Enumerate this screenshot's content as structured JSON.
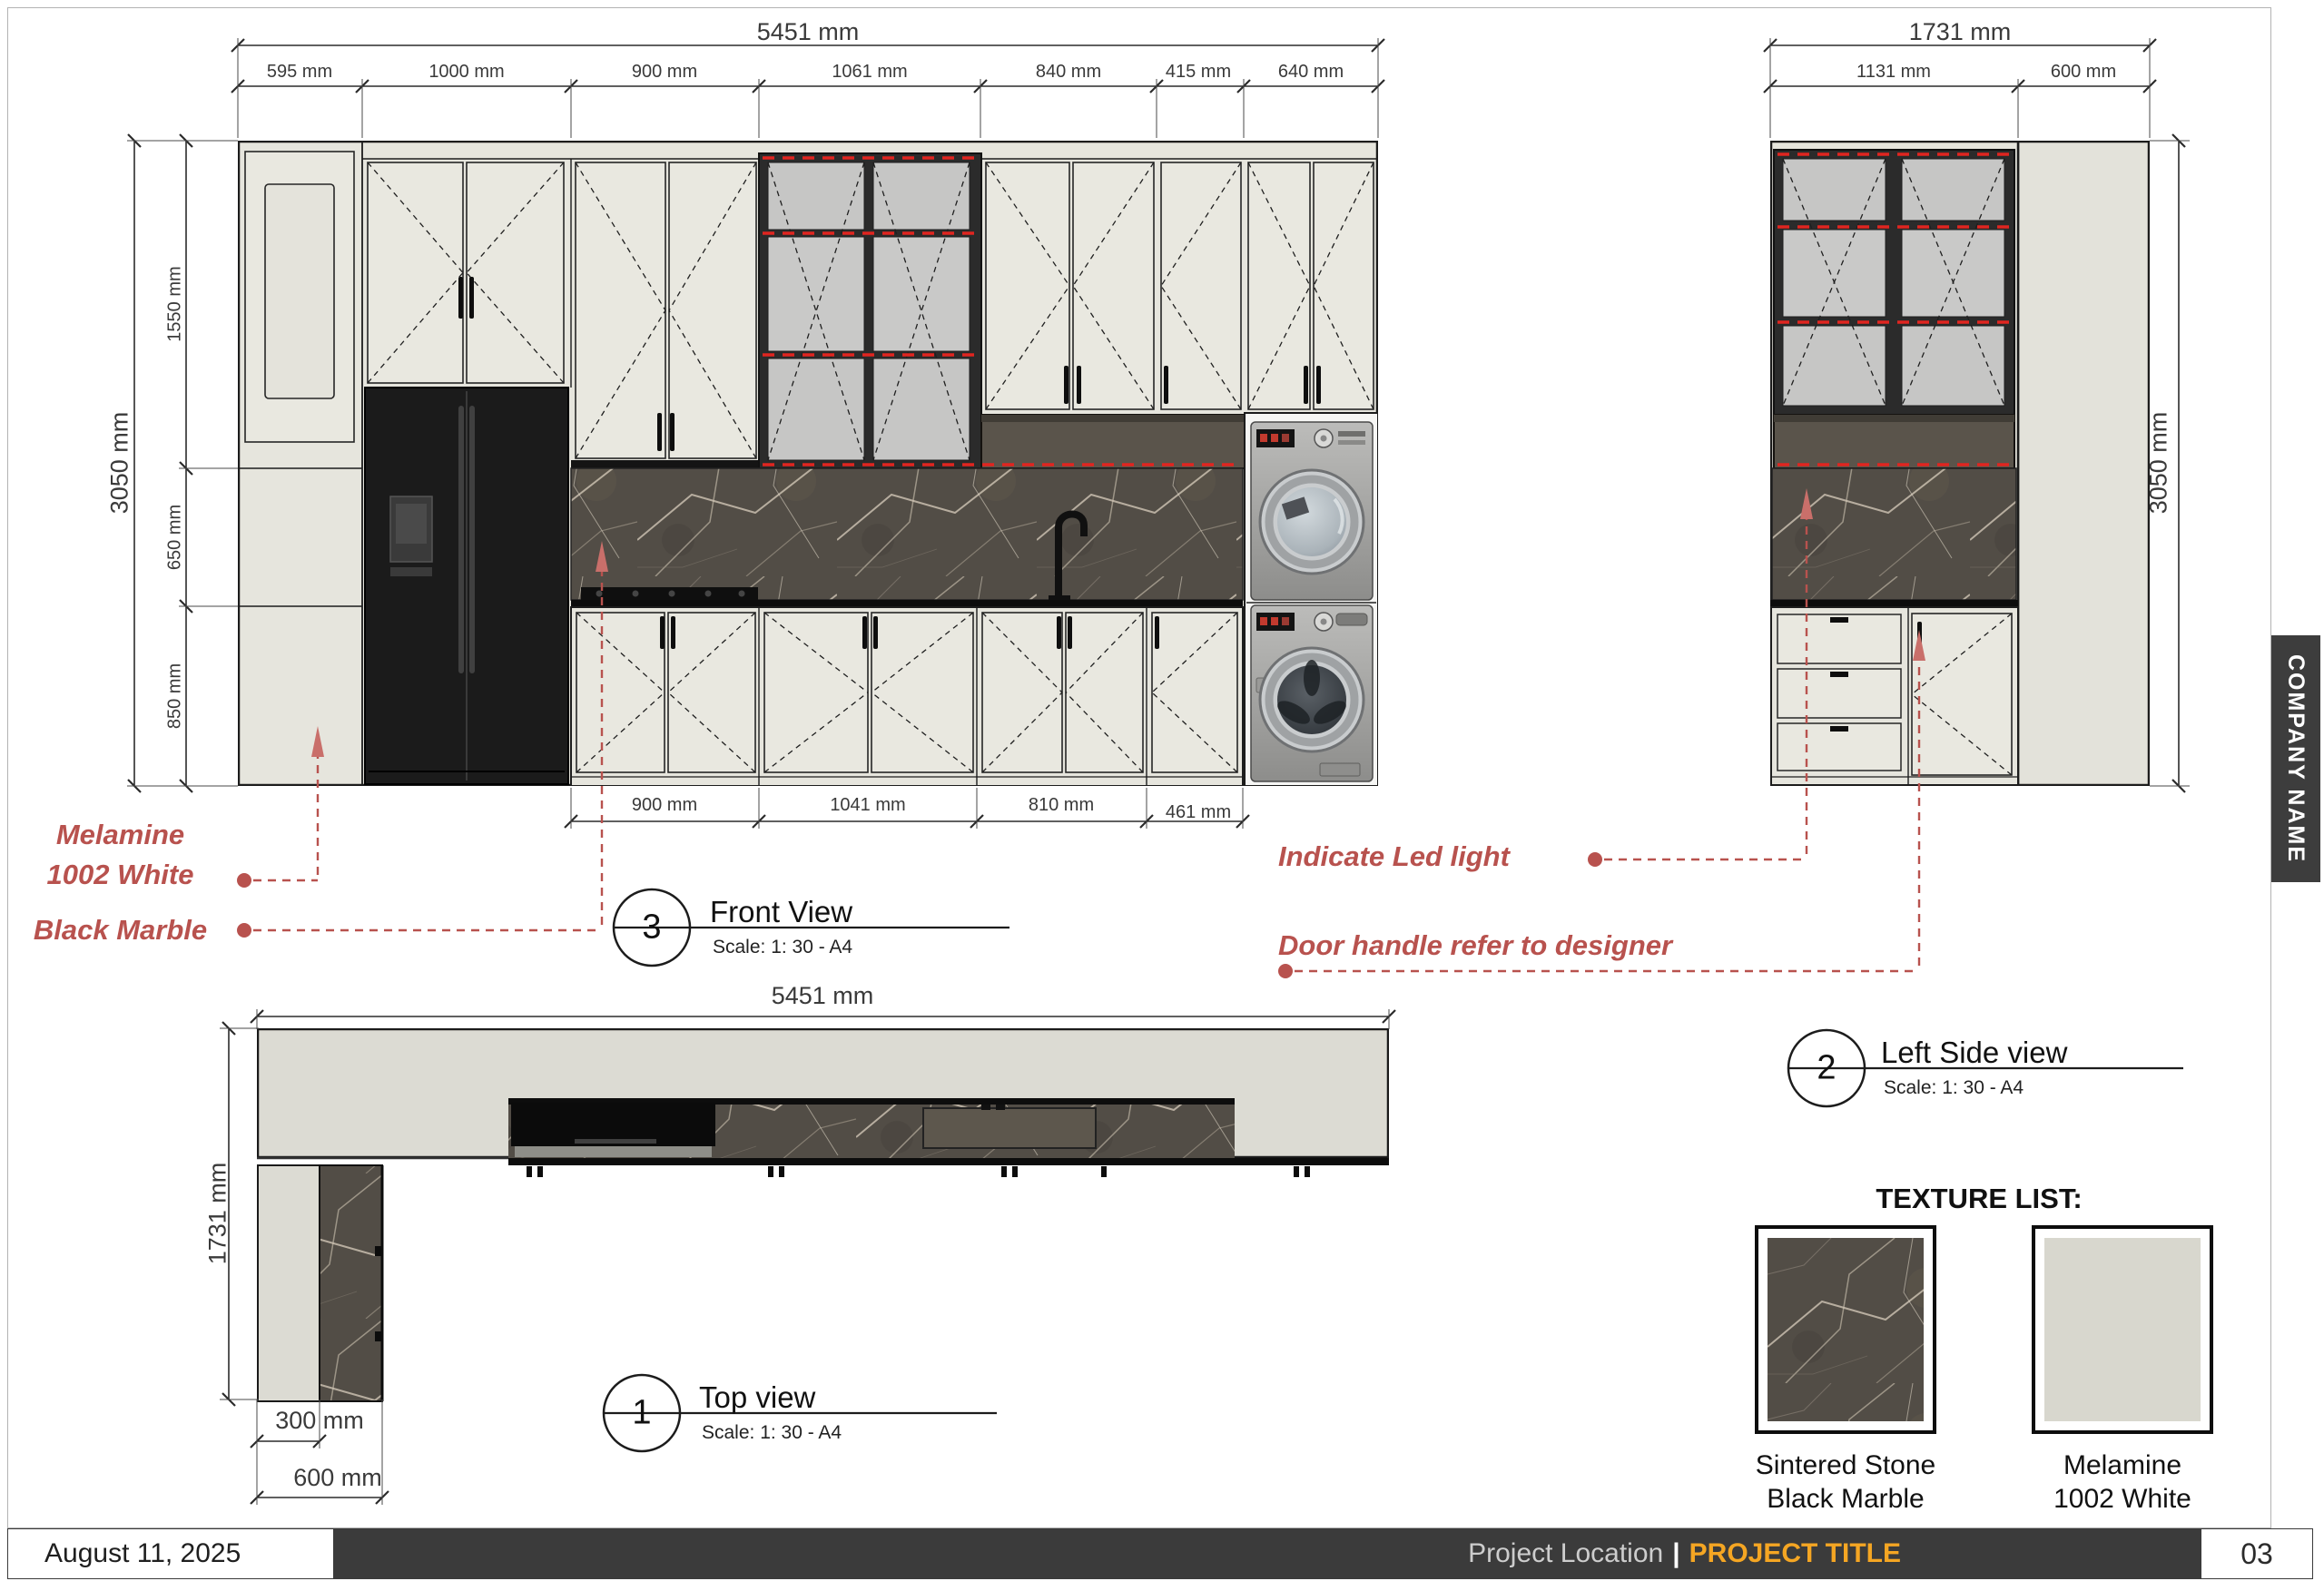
{
  "front_view": {
    "number": "3",
    "title": "Front View",
    "scale": "Scale: 1: 30 - A4",
    "dim_total_width": "5451 mm",
    "dim_top": [
      "595 mm",
      "1000 mm",
      "900 mm",
      "1061 mm",
      "840 mm",
      "415 mm",
      "640 mm"
    ],
    "dim_total_height": "3050 mm",
    "dim_left": [
      "1550 mm",
      "650 mm",
      "850 mm"
    ],
    "dim_bottom": [
      "900 mm",
      "1041 mm",
      "810 mm",
      "461 mm"
    ]
  },
  "side_view": {
    "number": "2",
    "title": "Left Side view",
    "scale": "Scale: 1: 30 - A4",
    "dim_total_width": "1731 mm",
    "dim_top": [
      "1131 mm",
      "600 mm"
    ],
    "dim_total_height": "3050 mm"
  },
  "top_view": {
    "number": "1",
    "title": "Top view",
    "scale": "Scale: 1: 30 - A4",
    "dim_total_width": "5451 mm",
    "dim_total_height": "1731 mm",
    "dim_inner": "300 mm",
    "dim_outer": "600 mm"
  },
  "annotations": {
    "melamine_line1": "Melamine",
    "melamine_line2": "1002 White",
    "black_marble": "Black Marble",
    "led_light": "Indicate Led light",
    "door_handle": "Door handle refer to designer"
  },
  "texture_list": {
    "title": "TEXTURE LIST:",
    "items": [
      {
        "line1": "Sintered Stone",
        "line2": "Black Marble"
      },
      {
        "line1": "Melamine",
        "line2": "1002 White"
      }
    ]
  },
  "sidebar": {
    "company": "COMPANY NAME"
  },
  "footer": {
    "date": "August 11, 2025",
    "location": "Project Location",
    "separator": "|",
    "project_title": "PROJECT TITLE",
    "page": "03"
  },
  "colors": {
    "annotation_red": "#b8524e",
    "led_red": "#e02520",
    "accent_orange": "#f5a623",
    "marble_base": "#524d46",
    "cabinet_fill": "#e6e5dd",
    "bar_dark": "#3b3b3b"
  }
}
